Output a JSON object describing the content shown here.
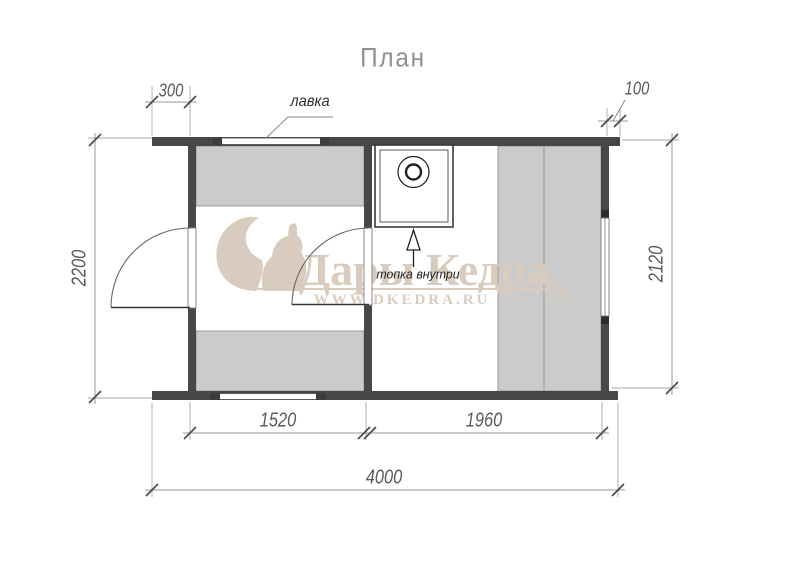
{
  "title": "План",
  "labels": {
    "bench": "лавка",
    "firebox": "топка внутри"
  },
  "dimensions": {
    "overhang_left": "300",
    "overhang_right": "100",
    "depth_left": "2200",
    "depth_right": "2120",
    "room_left_width": "1520",
    "room_right_width": "1960",
    "total_width": "4000"
  },
  "watermark": {
    "brand": "Дары Кедра",
    "website": "WWW.DKEDRA.RU"
  },
  "colors": {
    "wall": "#474747",
    "bench_fill": "#cbcbcb",
    "bench_border": "#949494",
    "dimension_line": "#9a9a9a",
    "dimension_text": "#5a5a5a",
    "watermark": "#d9ccbe",
    "background": "#ffffff"
  }
}
